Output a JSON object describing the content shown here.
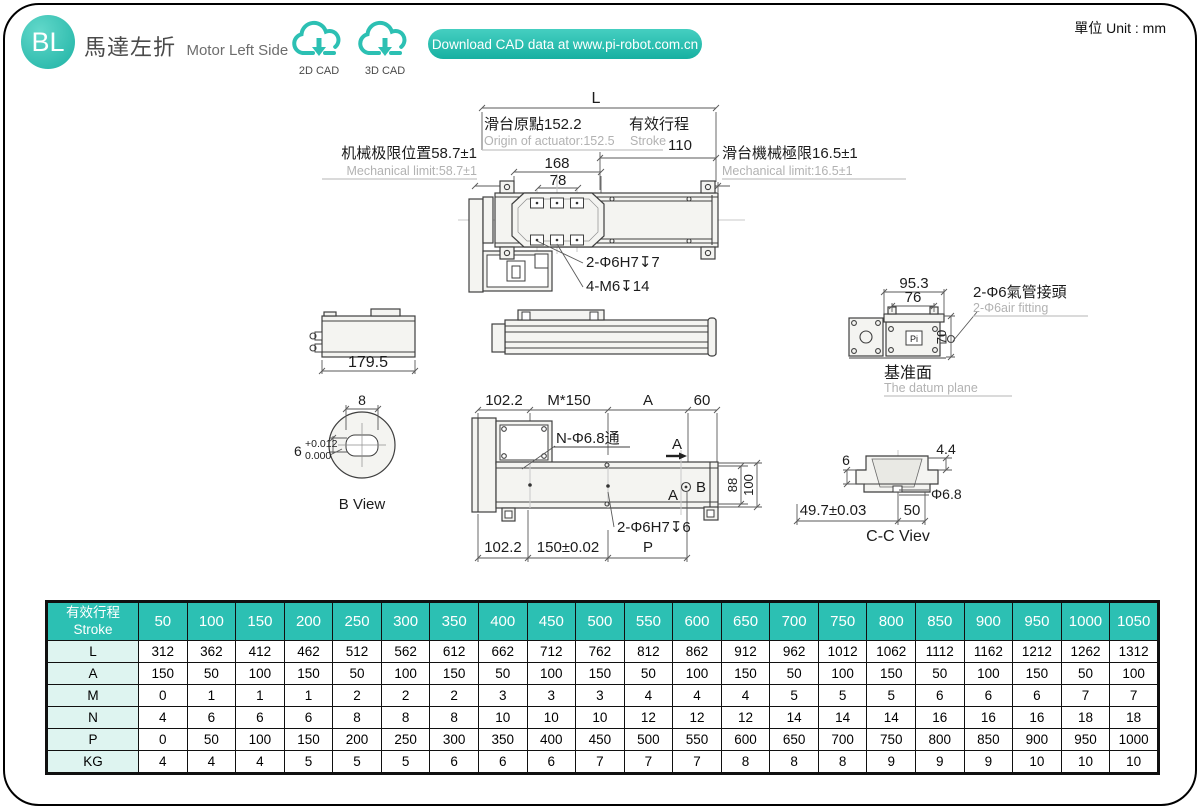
{
  "header": {
    "badge": "BL",
    "title_cn": "馬達左折",
    "title_en": "Motor Left Side",
    "cad_2d": "2D CAD",
    "cad_3d": "3D CAD",
    "download": "Download CAD data at www.pi-robot.com.cn",
    "unit": "單位 Unit : mm"
  },
  "drawing": {
    "top_view": {
      "dim_L": "L",
      "origin_cn": "滑台原點152.2",
      "origin_en": "Origin of actuator:152.5",
      "stroke_cn": "有效行程",
      "stroke_en": "Stroke",
      "stroke_val": "110",
      "mech_left_cn": "机械极限位置58.7±1",
      "mech_left_en": "Mechanical limit:58.7±1",
      "mech_right_cn": "滑台機械極限16.5±1",
      "mech_right_en": "Mechanical limit:16.5±1",
      "dim_168": "168",
      "dim_78": "78",
      "hole_note": "2-Φ6H7↧7",
      "thread_note": "4-M6↧14"
    },
    "side_view": {
      "dim_length": "179.5"
    },
    "end_view": {
      "dim_95_3": "95.3",
      "dim_76": "76",
      "dim_70": "70",
      "air_cn": "2-Φ6氣管接頭",
      "air_en": "2-Φ6air fitting",
      "logo": "Pi",
      "datum_cn": "基准面",
      "datum_en": "The datum plane"
    },
    "b_view": {
      "dim_8": "8",
      "dim_6": "6",
      "tol_plus": "+0.012",
      "tol_zero": "0.000",
      "label": "B View"
    },
    "bottom_view": {
      "dim_102_2_top": "102.2",
      "dim_m150": "M*150",
      "dim_A": "A",
      "dim_60": "60",
      "hole_note": "N-Φ6.8通",
      "sec_a_top": "A",
      "sec_a_bottom": "A",
      "sec_b": "B",
      "dim_88": "88",
      "dim_100": "100",
      "hole_note2": "2-Φ6H7↧6",
      "dim_102_2_bottom": "102.2",
      "dim_150": "150±0.02",
      "dim_P": "P"
    },
    "cc_view": {
      "dim_6": "6",
      "dim_4_4": "4.4",
      "dim_phi": "Φ6.8",
      "dim_49_7": "49.7±0.03",
      "dim_50": "50",
      "label": "C-C Viev"
    }
  },
  "table": {
    "header_cn": "有效行程",
    "header_en": "Stroke",
    "strokes": [
      "50",
      "100",
      "150",
      "200",
      "250",
      "300",
      "350",
      "400",
      "450",
      "500",
      "550",
      "600",
      "650",
      "700",
      "750",
      "800",
      "850",
      "900",
      "950",
      "1000",
      "1050"
    ],
    "rows": [
      {
        "label": "L",
        "values": [
          "312",
          "362",
          "412",
          "462",
          "512",
          "562",
          "612",
          "662",
          "712",
          "762",
          "812",
          "862",
          "912",
          "962",
          "1012",
          "1062",
          "1112",
          "1162",
          "1212",
          "1262",
          "1312"
        ]
      },
      {
        "label": "A",
        "values": [
          "150",
          "50",
          "100",
          "150",
          "50",
          "100",
          "150",
          "50",
          "100",
          "150",
          "50",
          "100",
          "150",
          "50",
          "100",
          "150",
          "50",
          "100",
          "150",
          "50",
          "100"
        ]
      },
      {
        "label": "M",
        "values": [
          "0",
          "1",
          "1",
          "1",
          "2",
          "2",
          "2",
          "3",
          "3",
          "3",
          "4",
          "4",
          "4",
          "5",
          "5",
          "5",
          "6",
          "6",
          "6",
          "7",
          "7"
        ]
      },
      {
        "label": "N",
        "values": [
          "4",
          "6",
          "6",
          "6",
          "8",
          "8",
          "8",
          "10",
          "10",
          "10",
          "12",
          "12",
          "12",
          "14",
          "14",
          "14",
          "16",
          "16",
          "16",
          "18",
          "18"
        ]
      },
      {
        "label": "P",
        "values": [
          "0",
          "50",
          "100",
          "150",
          "200",
          "250",
          "300",
          "350",
          "400",
          "450",
          "500",
          "550",
          "600",
          "650",
          "700",
          "750",
          "800",
          "850",
          "900",
          "950",
          "1000"
        ]
      },
      {
        "label": "KG",
        "values": [
          "4",
          "4",
          "4",
          "5",
          "5",
          "5",
          "6",
          "6",
          "6",
          "7",
          "7",
          "7",
          "8",
          "8",
          "8",
          "9",
          "9",
          "9",
          "10",
          "10",
          "10"
        ]
      }
    ]
  },
  "colors": {
    "teal": "#2cc0b3",
    "mint": "#def4f0",
    "gray_text": "#b2b2b2"
  }
}
